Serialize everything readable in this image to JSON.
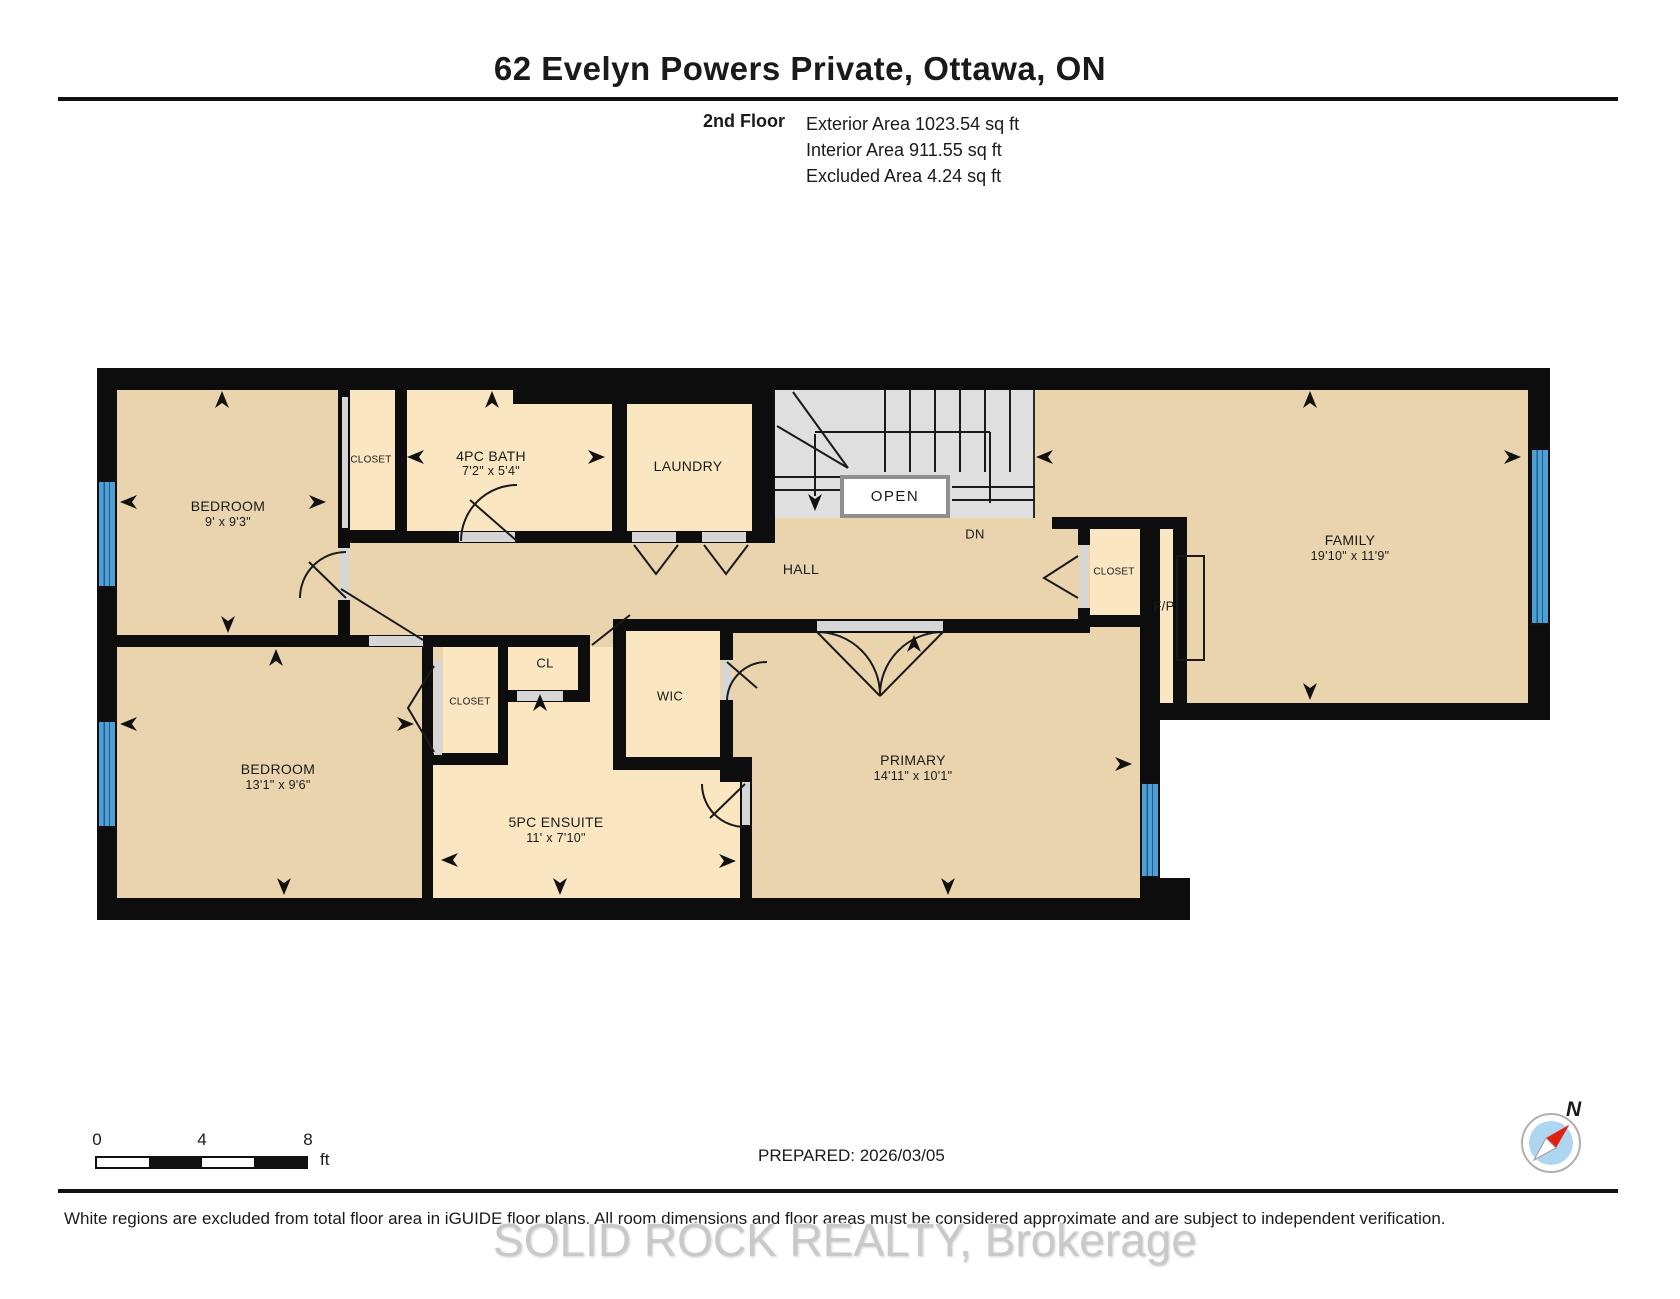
{
  "header": {
    "title": "62 Evelyn Powers Private, Ottawa, ON",
    "floor_label": "2nd Floor",
    "stats": [
      "Exterior Area 1023.54 sq ft",
      "Interior Area 911.55 sq ft",
      "Excluded Area 4.24 sq ft"
    ]
  },
  "plan": {
    "rooms": {
      "bedroom1": {
        "name": "BEDROOM",
        "dims": "9' x 9'3\""
      },
      "closet1": {
        "name": "CLOSET"
      },
      "bath": {
        "name": "4PC BATH",
        "dims": "7'2\" x 5'4\""
      },
      "laundry": {
        "name": "LAUNDRY"
      },
      "stairs": {
        "open_label": "OPEN",
        "down_label": "DN"
      },
      "hall": {
        "name": "HALL"
      },
      "closet_hall": {
        "name": "CLOSET"
      },
      "fireplace": {
        "name": "F/P"
      },
      "family": {
        "name": "FAMILY",
        "dims": "19'10\" x 11'9\""
      },
      "bedroom2": {
        "name": "BEDROOM",
        "dims": "13'1\" x 9'6\""
      },
      "closet2": {
        "name": "CLOSET"
      },
      "cl": {
        "name": "CL"
      },
      "wic": {
        "name": "WIC"
      },
      "ensuite": {
        "name": "5PC ENSUITE",
        "dims": "11' x 7'10\""
      },
      "primary": {
        "name": "PRIMARY",
        "dims": "14'11\" x 10'1\""
      }
    }
  },
  "footer": {
    "scale": {
      "ticks": [
        "0",
        "4",
        "8"
      ],
      "unit": "ft"
    },
    "prepared": "PREPARED: 2026/03/05",
    "compass_label": "N",
    "disclaimer": "White regions are excluded from total floor area in iGUIDE floor plans. All room dimensions and floor areas must be considered approximate and are subject to independent verification.",
    "watermark": "SOLID ROCK REALTY, Brokerage"
  },
  "colors": {
    "room_dark": "#e9d4ae",
    "room_light": "#fbe6c2",
    "stairs": "#dfdfdf",
    "window": "#4d9fd4",
    "wall": "#0d0d0d"
  }
}
